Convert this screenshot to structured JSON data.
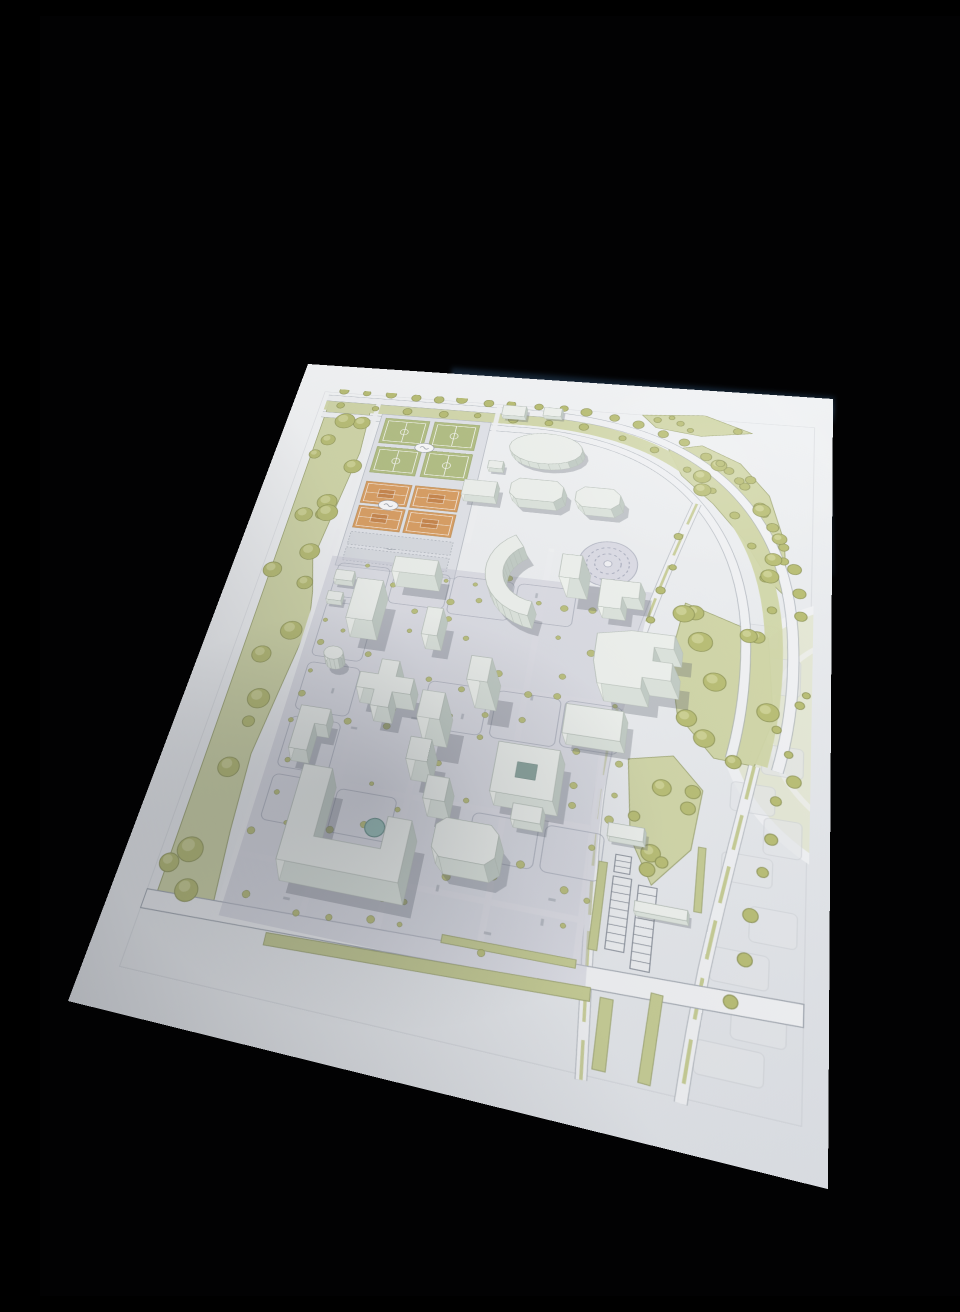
{
  "scene": {
    "kind": "photograph",
    "subject": "architectural masterplan scale model with white 3d-printed buildings on a printed site plan, shot at an angle on a black background",
    "background_color": "#020203",
    "palette": {
      "paper": "#f2f3f5",
      "paper_dark": "#e1e4e8",
      "lawn": "#d4d9ab",
      "lawn_edge": "#a3aa78",
      "tree_fill": "#bcc178",
      "tree_edge": "#8e9557",
      "tree_light": "#d8dca2",
      "road_fill": "#f3f4f6",
      "road_edge": "#a6acb4",
      "median": "#c9cf97",
      "pavement": "#c9cad6",
      "plot_line": "#8d93a2",
      "court_green": "#b6c287",
      "court_orange": "#dda266",
      "court_orange_dark": "#c9854b",
      "building_top": "#f1f4f0",
      "building_front": "#e0e7e0",
      "building_right": "#c6d0c9",
      "building_left": "#f4f7f2",
      "building_up": "#ebf0ea",
      "building_edge": "#b7c0b8",
      "cast_shadow": "#5c636e",
      "pond": "#9cc0ba",
      "courtyard": "#8fa8a1",
      "context_fill": "#e9ebee",
      "context_line": "#d5d8dc",
      "glare_blue": "#2c4157",
      "glare_blue_dark": "#0a141f"
    }
  }
}
